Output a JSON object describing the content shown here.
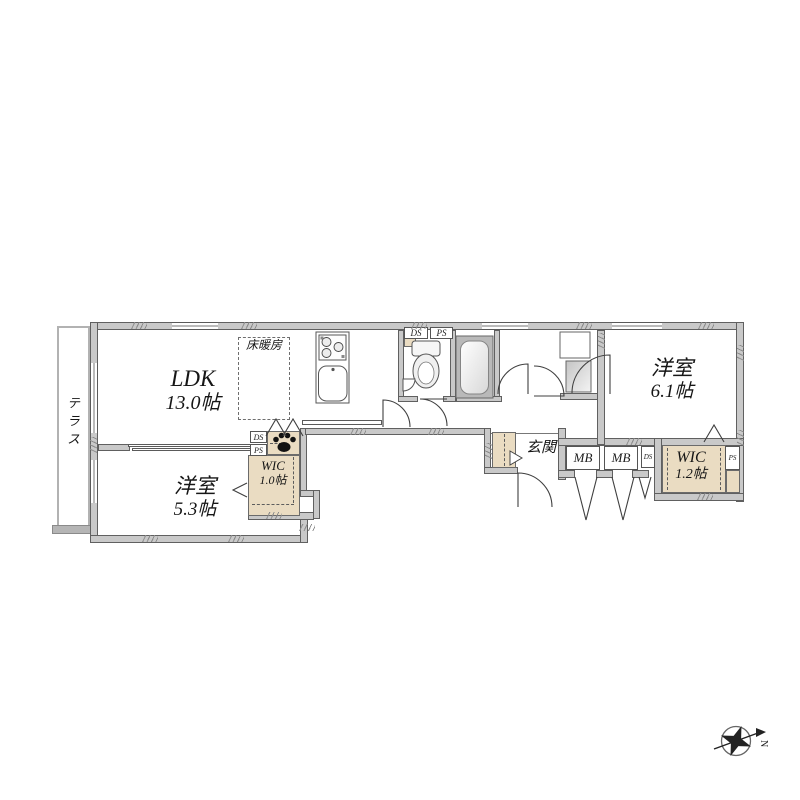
{
  "plan": {
    "terrace": "テラス",
    "ldk": {
      "name": "LDK",
      "area": "13.0帖"
    },
    "floor_heating": "床暖房",
    "bedroom_small": {
      "name": "洋室",
      "area": "5.3帖"
    },
    "bedroom_large": {
      "name": "洋室",
      "area": "6.1帖"
    },
    "wic_small": {
      "name": "WIC",
      "area": "1.0帖"
    },
    "wic_large": {
      "name": "WIC",
      "area": "1.2帖"
    },
    "entrance": "玄関"
  },
  "labels": {
    "mb": "MB",
    "ds": "DS",
    "ps": "PS"
  },
  "compass": {
    "north": "N"
  },
  "colors": {
    "wall_fill": "#c9c9c9",
    "wall_line": "#606060",
    "closet_fill": "#eadcc2",
    "tub_surround": "#b9b9b9",
    "paw": "#121212",
    "background": "#ffffff"
  }
}
